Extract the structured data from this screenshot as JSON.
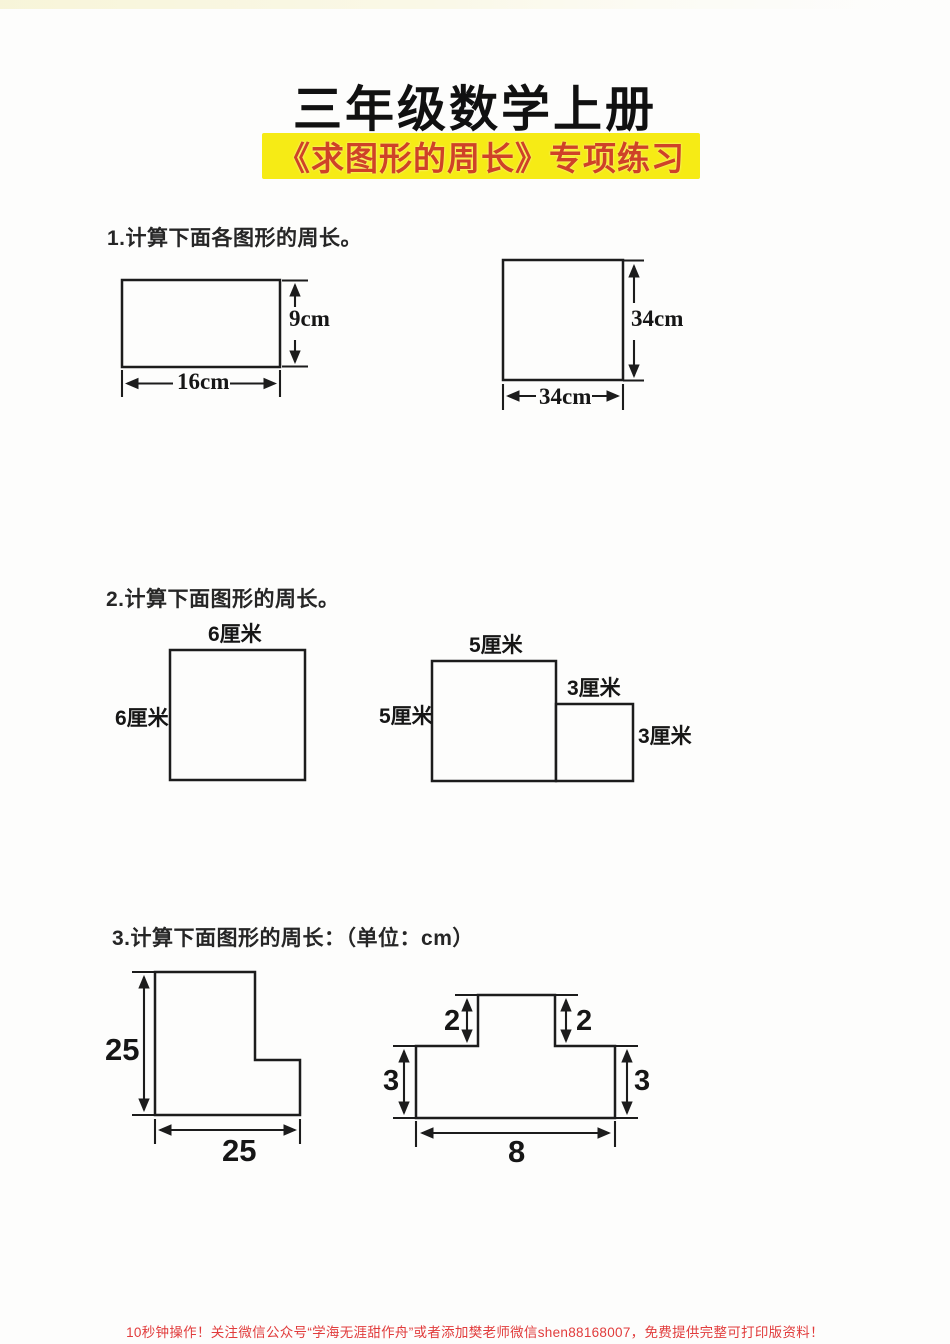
{
  "header": {
    "title": "三年级数学上册",
    "banner": "《求图形的周长》专项练习"
  },
  "colors": {
    "banner_bg": "#f6eb15",
    "banner_text": "#cf4227",
    "footer_text": "#e13c3c",
    "ink": "#1c1c1c"
  },
  "questions": {
    "q1": {
      "prompt": "1.计算下面各图形的周长。",
      "rect": {
        "height_label": "9cm",
        "width_label": "16cm"
      },
      "square": {
        "height_label": "34cm",
        "width_label": "34cm"
      }
    },
    "q2": {
      "prompt": "2.计算下面图形的周长。",
      "square": {
        "top_label": "6厘米",
        "left_label": "6厘米"
      },
      "step": {
        "big_top_label": "5厘米",
        "big_left_label": "5厘米",
        "small_top_label": "3厘米",
        "small_right_label": "3厘米"
      }
    },
    "q3": {
      "prompt": "3.计算下面图形的周长：（单位：cm）",
      "l_shape": {
        "left_label": "25",
        "bottom_label": "25"
      },
      "t_shape": {
        "top_left_label": "2",
        "top_right_label": "2",
        "left_label": "3",
        "right_label": "3",
        "bottom_label": "8"
      }
    }
  },
  "footer": {
    "text": "10秒钟操作！关注微信公众号“学海无涯甜作舟”或者添加樊老师微信shen88168007，免费提供完整可打印版资料！"
  }
}
